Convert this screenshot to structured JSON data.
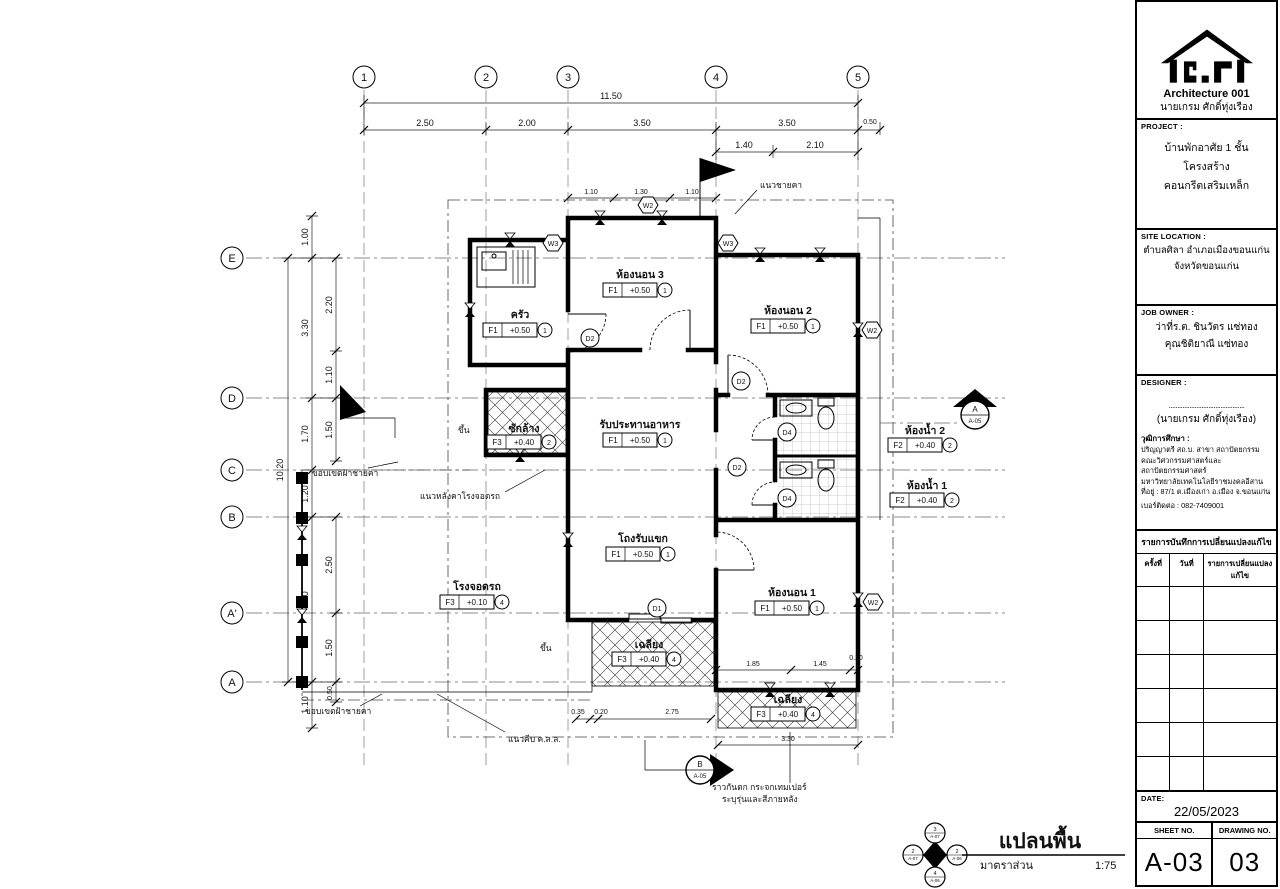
{
  "title_block": {
    "logo_title": "Architecture 001",
    "logo_subtitle": "นายเกรม ศักดิ์ทุ่งเรือง",
    "project": {
      "label": "PROJECT :",
      "line1": "บ้านพักอาศัย 1 ชั้น",
      "line2": "โครงสร้างคอนกรีตเสริมเหล็ก"
    },
    "site": {
      "label": "SITE LOCATION :",
      "line1": "ตำบลศิลา อำเภอเมืองขอนแก่น",
      "line2": "จังหวัดขอนแก่น"
    },
    "owner": {
      "label": "JOB OWNER :",
      "line1": "ว่าที่ร.ต. ชินวัตร แซ่ทอง",
      "line2": "คุณชิติยาณี แซ่ทอง"
    },
    "designer": {
      "label": "DESIGNER :",
      "sign_line": "............................................",
      "name": "(นายเกรม ศักดิ์ทุ่งเรือง)",
      "edu_label": "วุฒิการศึกษา :",
      "edu1": "ปริญญาตรี สถ.บ. สาขา สถาปัตยกรรม",
      "edu2": "คณะวิศวกรรมศาสตร์และสถาปัตยกรรมศาสตร์",
      "edu3": "มหาวิทยาลัยเทคโนโลยีราชมงคลอีสาน",
      "edu4": "ที่อยู่ : 87/1 ต.เมืองเก่า อ.เมือง จ.ขอนแก่น",
      "edu5": "เบอร์ติดต่อ : 082-7409001"
    },
    "revisions": {
      "title": "รายการบันทึกการเปลี่ยนแปลงแก้ไข",
      "col1": "ครั้งที่",
      "col2": "วันที่",
      "col3": "รายการเปลี่ยนแปลง แก้ไข"
    },
    "date_label": "DATE:",
    "date": "22/05/2023",
    "sheet_label": "SHEET NO.",
    "sheet": "A-03",
    "drawing_label": "DRAWING NO.",
    "drawing": "03"
  },
  "plan": {
    "title": "แปลนพื้น",
    "scale_label": "มาตราส่วน",
    "scale": "1:75",
    "grid_cols": [
      "1",
      "2",
      "3",
      "4",
      "5"
    ],
    "grid_rows": [
      "E",
      "D",
      "C",
      "B",
      "A'",
      "A"
    ],
    "dims_top": {
      "overall": "11.50",
      "chain": [
        "2.50",
        "2.00",
        "3.50",
        "3.50",
        "0.50"
      ],
      "sub": [
        "1.40",
        "2.10"
      ],
      "win": [
        "1.10",
        "1.30",
        "1.10"
      ]
    },
    "dims_left": {
      "overall": "10.20",
      "chain": [
        "1.00",
        "3.30",
        "1.70",
        "1.20",
        "4.00",
        "1.10"
      ],
      "inner": [
        "2.20",
        "1.10",
        "1.50",
        "2.50",
        "1.50",
        "0.50"
      ]
    },
    "dims_bottom": [
      "0.35",
      "0.20",
      "2.75",
      "3.30",
      "1.85",
      "1.45",
      "0.20"
    ],
    "rooms": [
      {
        "name": "ครัว",
        "code": "F1",
        "level": "+0.50",
        "mat": "1"
      },
      {
        "name": "ห้องนอน 3",
        "code": "F1",
        "level": "+0.50",
        "mat": "1"
      },
      {
        "name": "ห้องนอน 2",
        "code": "F1",
        "level": "+0.50",
        "mat": "1"
      },
      {
        "name": "รับประทานอาหาร",
        "code": "F1",
        "level": "+0.50",
        "mat": "1"
      },
      {
        "name": "ซักล้าง",
        "code": "F3",
        "level": "+0.40",
        "mat": "2"
      },
      {
        "name": "ห้องน้ำ 2",
        "code": "F2",
        "level": "+0.40",
        "mat": "2"
      },
      {
        "name": "ห้องน้ำ 1",
        "code": "F2",
        "level": "+0.40",
        "mat": "2"
      },
      {
        "name": "โถงรับแขก",
        "code": "F1",
        "level": "+0.50",
        "mat": "1"
      },
      {
        "name": "ห้องนอน 1",
        "code": "F1",
        "level": "+0.50",
        "mat": "1"
      },
      {
        "name": "โรงจอดรถ",
        "code": "F3",
        "level": "+0.10",
        "mat": "4"
      },
      {
        "name": "เฉลียง",
        "code": "F3",
        "level": "+0.40",
        "mat": "4"
      },
      {
        "name": "เฉลียง",
        "code": "F3",
        "level": "+0.40",
        "mat": "4"
      }
    ],
    "tags_hex": [
      {
        "label": "W3"
      },
      {
        "label": "W2"
      },
      {
        "label": "W3"
      },
      {
        "label": "W2"
      },
      {
        "label": "W2"
      }
    ],
    "tags_circle": [
      {
        "label": "D2"
      },
      {
        "label": "D2"
      },
      {
        "label": "D2"
      },
      {
        "label": "D1"
      },
      {
        "label": "D4"
      },
      {
        "label": "D4"
      }
    ],
    "annotations": {
      "eave": "แนวชายคา",
      "garage_roof": "แนวหลังคาโรงจอดรถ",
      "ceiling1": "ขอบเขตฝ้าชายคา",
      "ceiling2": "ขอบเขตฝ้าชายคา",
      "curb": "แนวคีบ ค.ส.ล.",
      "rail1": "ราวกันตก กระจกเทมเปอร์",
      "rail2": "ระบุรุ่นและสีภายหลัง",
      "up1": "ขึ้น",
      "up2": "ขึ้น"
    },
    "section_markers": {
      "right": {
        "letter": "A",
        "sheet": "A-05"
      },
      "bottom": {
        "letter": "B",
        "sheet": "A-05"
      }
    },
    "compass": [
      {
        "num": "3",
        "sheet": "A-07"
      },
      {
        "num": "2",
        "sheet": "A-07"
      },
      {
        "num": "2",
        "sheet": "A-06"
      },
      {
        "num": "4",
        "sheet": "A-06"
      }
    ]
  }
}
